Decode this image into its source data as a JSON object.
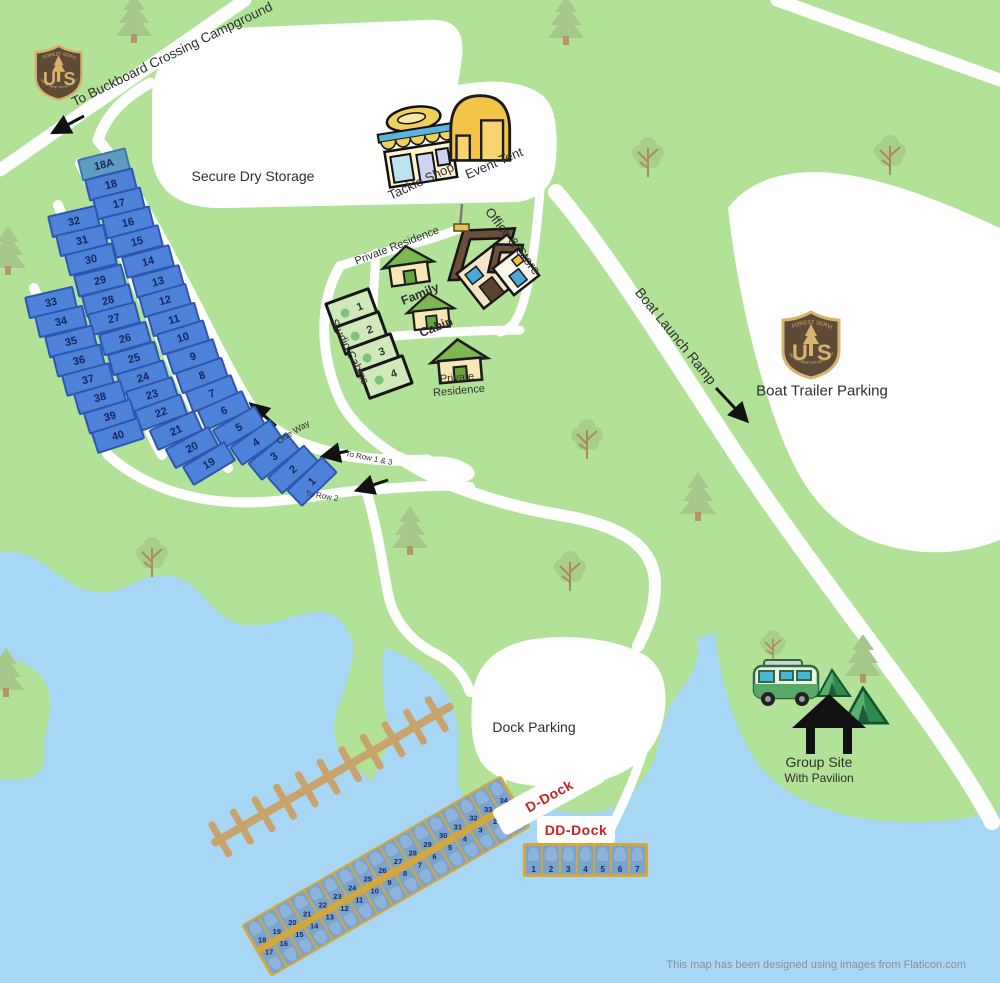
{
  "labels": {
    "to_buckboard": "To Buckboard Crossing Campground",
    "secure_dry_storage": "Secure Dry Storage",
    "tackle_shop": "Tackle Shop",
    "event_tent": "Event Tent",
    "office_store": "Office & Store",
    "private_residence_top": "Private Residence",
    "family": "Family",
    "cabin": "Cabin",
    "studio_cabins": "Studio Cabins",
    "private": "Private",
    "residence": "Residence",
    "one_way": "One Way",
    "to_row_1_3": "To Row 1 & 3",
    "to_row_2": "To Row 2",
    "boat_launch_ramp": "Boat Launch Ramp",
    "boat_trailer_parking": "Boat Trailer Parking",
    "dock_parking": "Dock Parking",
    "d_dock": "D-Dock",
    "dd_dock": "DD-Dock",
    "group_site": "Group Site",
    "with_pavilion": "With Pavilion"
  },
  "badge": {
    "top": "FOREST SERVICE",
    "letter_u": "U",
    "letter_s": "S",
    "bottom": "DEPARTMENT OF AGRICULTURE"
  },
  "campsites": {
    "row1": [
      "18A",
      "18",
      "17",
      "16",
      "15",
      "14",
      "13",
      "12",
      "11",
      "10",
      "9",
      "8",
      "7",
      "6",
      "5",
      "4",
      "3",
      "2",
      "1"
    ],
    "row2": [
      "32",
      "31",
      "30",
      "29",
      "28",
      "27",
      "26",
      "25",
      "24",
      "23",
      "22",
      "21",
      "20",
      "19"
    ],
    "row3": [
      "33",
      "34",
      "35",
      "36",
      "37",
      "38",
      "39",
      "40"
    ]
  },
  "studio_units": [
    "1",
    "2",
    "3",
    "4"
  ],
  "d_dock": {
    "north_slips": [
      "18",
      "19",
      "20",
      "21",
      "22",
      "23",
      "24",
      "25",
      "26",
      "27",
      "28",
      "29",
      "30",
      "31",
      "32",
      "33",
      "34"
    ],
    "south_slips": [
      "17",
      "16",
      "15",
      "14",
      "13",
      "12",
      "11",
      "10",
      "9",
      "8",
      "7",
      "6",
      "5",
      "4",
      "3",
      "2",
      "1"
    ]
  },
  "dd_dock": {
    "slips": [
      "1",
      "2",
      "3",
      "4",
      "5",
      "6",
      "7"
    ]
  },
  "attribution": "This map has been designed using images from Flaticon.com",
  "colors": {
    "land": "#b1e298",
    "water": "#a8d7f5",
    "road": "#ffffff",
    "campsite_fill": "#4d82d8",
    "campsite_18a_fill": "#5f9cc4",
    "dock_fill": "#d2a83e",
    "slip_fill": "#7ba3cc",
    "dock_label_red": "#cc2222",
    "badge_brown": "#5d4a37",
    "badge_tan": "#d9b36e"
  }
}
